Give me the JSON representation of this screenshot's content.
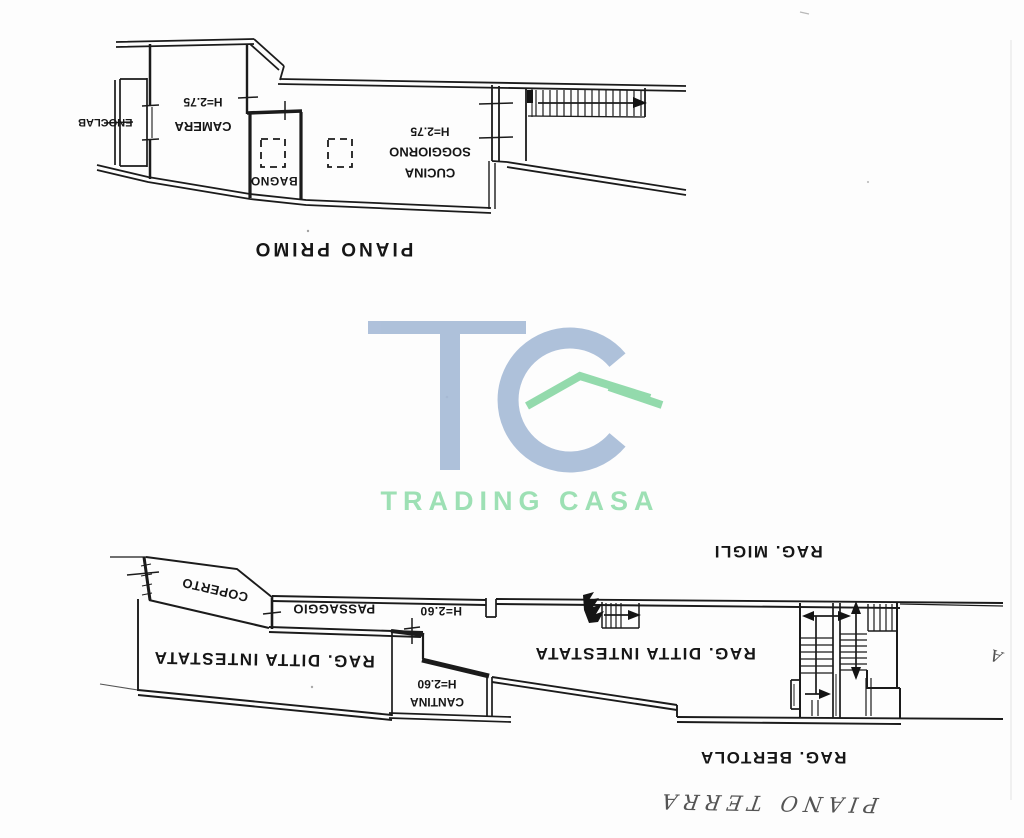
{
  "first_floor": {
    "title": "PIANO PRIMO",
    "balcony": "BALCONE",
    "bedroom": "CAMERA",
    "bedroom_height": "H=2.75",
    "bathroom": "BAGNO",
    "kitchen_line1": "CUCINA",
    "kitchen_line2": "SOGGIORNO",
    "kitchen_height": "H=2.75"
  },
  "ground_floor": {
    "title": "PIANO TERRA",
    "covered_area": "COPERTO",
    "passage": "PASSAGGIO",
    "passage_height": "H=2.60",
    "left_unit": "RAG. DITTA INTESTATA",
    "cellar": "CANTINA",
    "cellar_height": "H=2.60",
    "right_unit": "RAG. DITTA INTESTATA",
    "neighbor_upper": "RAG. MIGLI",
    "neighbor_lower": "RAG. BERTOLA",
    "annotation": "A"
  },
  "watermark": {
    "monogram": "TC",
    "name": "TRADING CASA",
    "colors": {
      "monogram_blue": "#a8bcd8",
      "roof_green": "#8bd8a6",
      "text_green": "#9de0b4"
    }
  }
}
